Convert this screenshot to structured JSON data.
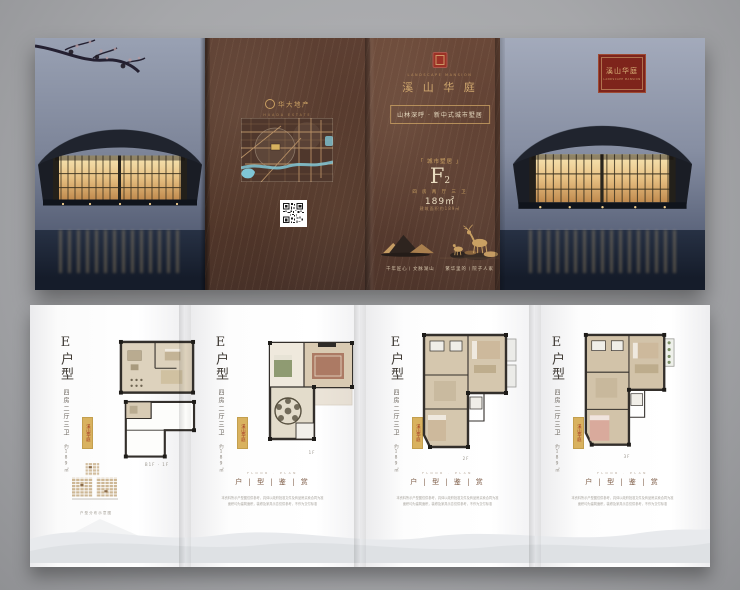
{
  "colors": {
    "background": "#a7a8aa",
    "brochure_brown": "#5f4234",
    "gold": "#c9a063",
    "cream": "#e9dcc0",
    "seal_red": "#9c3226",
    "water_blue": "#7fc6d6",
    "plan_tan": "#d5c7ae"
  },
  "top": {
    "developer": {
      "name": "华大地产",
      "sub": "HUADA ESTATE"
    },
    "brand": {
      "name_en": "LANDSCAPE MANSION",
      "name_cn": "溪 山 华 庭"
    },
    "slogan_boxed": "山林深呼 · 新中式城市墅居",
    "unit": {
      "bracket": "「 城市墅居 」",
      "code": "F",
      "code_sub": "2",
      "spec": "四 房 两 厅 三 卫",
      "area": "189㎡",
      "note": "建筑面积约189㎡"
    },
    "footer_slogan": "千年匠心丨文脉湖山　　繁华里的丨院子人家",
    "plaque": {
      "cn": "溪山华庭",
      "en": "LANDSCAPE MANSION"
    }
  },
  "bottom": {
    "section": {
      "eyebrow": "FLOOR · PLAN",
      "label": "户 | 型 | 鉴 | 赏"
    },
    "disclaimer1": "本资料所示户型图仅供参考，具体以政府批准文件及商品房买卖合同为准",
    "disclaimer2": "面积均为建筑面积，装修及家具示意仅供参考，不作为交付标准",
    "diagram_caption": "户型分布示意图",
    "panels": [
      {
        "title": "E户型",
        "spec": "四房二厅三卫",
        "area": "约189㎡",
        "seal": "溪山华庭",
        "floor": "B1F · 1F"
      },
      {
        "title": "E户型",
        "spec": "四房二厅三卫",
        "area": "约189㎡",
        "seal": "溪山华庭",
        "floor": "1F"
      },
      {
        "title": "E户型",
        "spec": "四房二厅三卫",
        "area": "约189㎡",
        "seal": "溪山华庭",
        "floor": "2F"
      },
      {
        "title": "E户型",
        "spec": "四房二厅三卫",
        "area": "约189㎡",
        "seal": "溪山华庭",
        "floor": "3F"
      }
    ]
  }
}
